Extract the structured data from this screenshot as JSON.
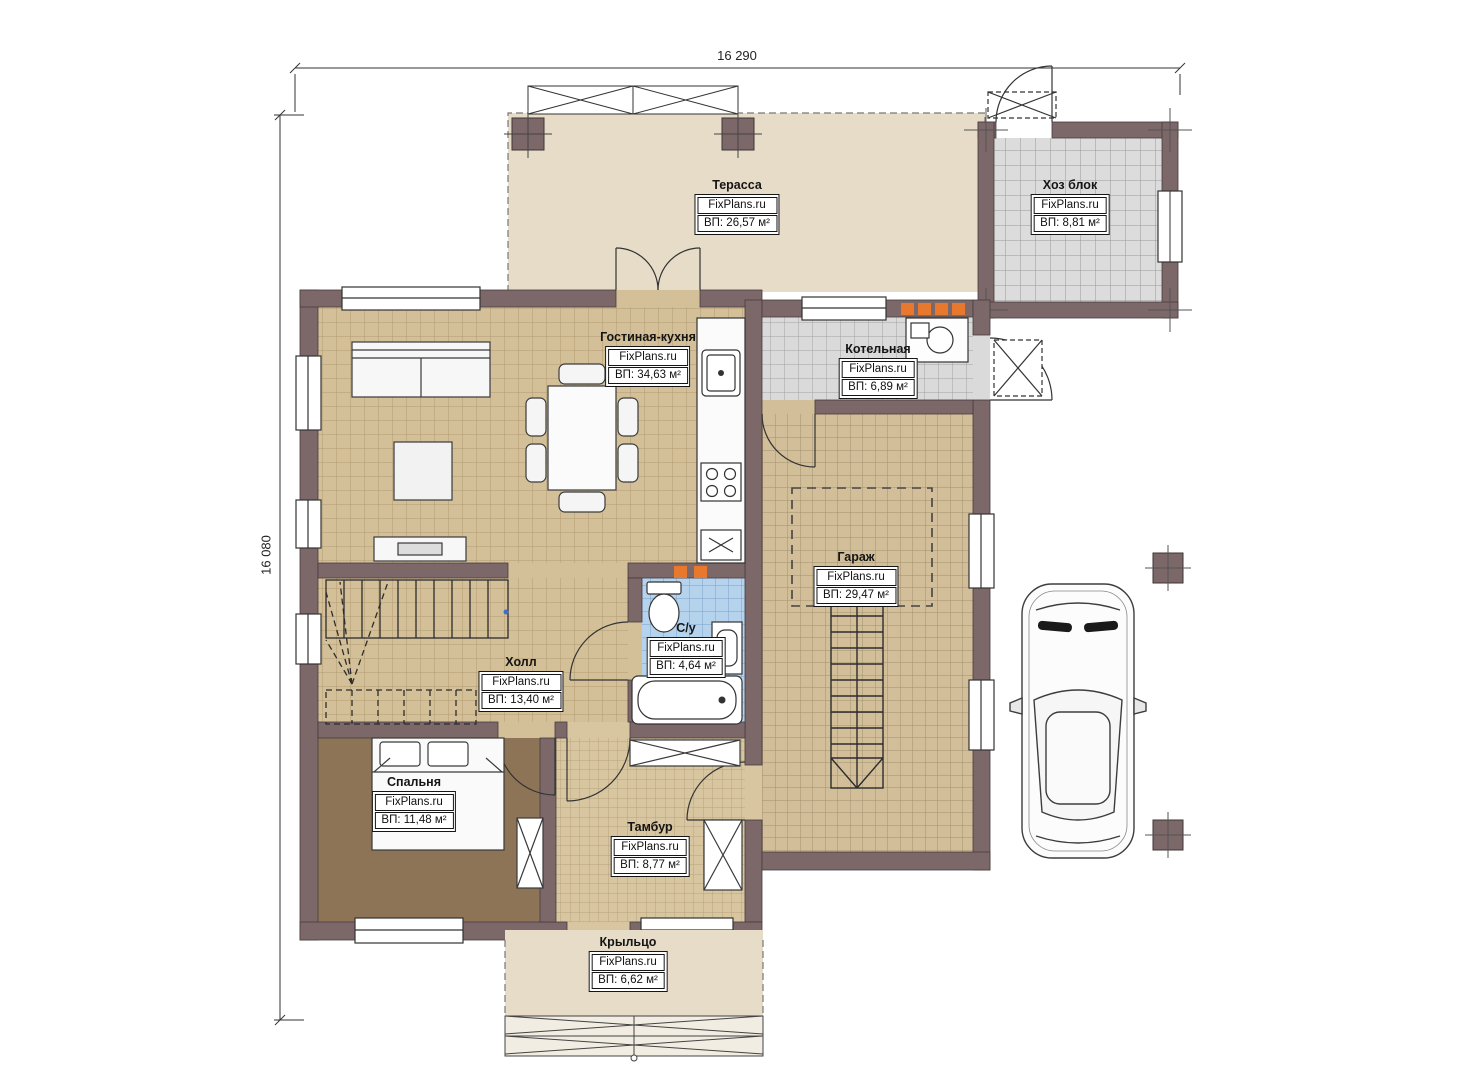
{
  "dimensions": {
    "width_label": "16 290",
    "height_label": "16 080"
  },
  "brand": "FixPlans.ru",
  "rooms": [
    {
      "key": "terrace",
      "name": "Терасса",
      "brand": "FixPlans.ru",
      "area": "ВП: 26,57 м²"
    },
    {
      "key": "utility",
      "name": "Хоз блок",
      "brand": "FixPlans.ru",
      "area": "ВП: 8,81 м²"
    },
    {
      "key": "living",
      "name": "Гостиная-кухня",
      "brand": "FixPlans.ru",
      "area": "ВП: 34,63 м²"
    },
    {
      "key": "boiler",
      "name": "Котельная",
      "brand": "FixPlans.ru",
      "area": "ВП: 6,89 м²"
    },
    {
      "key": "garage",
      "name": "Гараж",
      "brand": "FixPlans.ru",
      "area": "ВП: 29,47 м²"
    },
    {
      "key": "bathroom",
      "name": "С/у",
      "brand": "FixPlans.ru",
      "area": "ВП: 4,64 м²"
    },
    {
      "key": "hall",
      "name": "Холл",
      "brand": "FixPlans.ru",
      "area": "ВП: 13,40 м²"
    },
    {
      "key": "bedroom",
      "name": "Спальня",
      "brand": "FixPlans.ru",
      "area": "ВП: 11,48 м²"
    },
    {
      "key": "tambur",
      "name": "Тамбур",
      "brand": "FixPlans.ru",
      "area": "ВП: 8,77 м²"
    },
    {
      "key": "porch",
      "name": "Крыльцо",
      "brand": "FixPlans.ru",
      "area": "ВП: 6,62 м²"
    }
  ],
  "colors": {
    "wall": "#7c6769",
    "floor_tan": "#d4c098",
    "floor_gray": "#dadada",
    "floor_blue": "#b5d3ed",
    "floor_bedroom": "#8d7456",
    "floor_beige": "#e6dcc8",
    "accent_orange": "#e8782e"
  }
}
